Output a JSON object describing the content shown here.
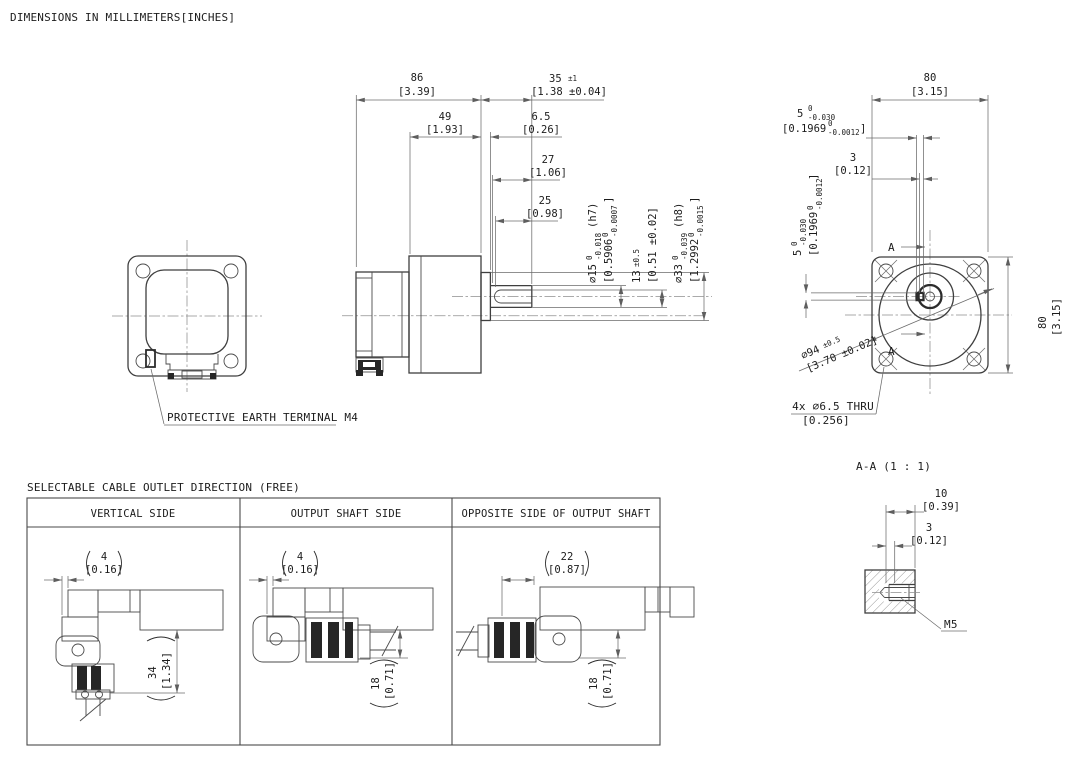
{
  "note": "DIMENSIONS IN MILLIMETERS[INCHES]",
  "colors": {
    "object_line": "#3f3f3f",
    "dim_line": "#6b6b6b",
    "text": "#1c1c1c",
    "background": "#ffffff"
  },
  "side_view": {
    "d86": {
      "mm": "86",
      "inch": "[3.39]"
    },
    "d35": {
      "mm": "35",
      "tol": "±1",
      "inch": "[1.38 ±0.04]"
    },
    "d49": {
      "mm": "49",
      "inch": "[1.93]"
    },
    "d6_5": {
      "mm": "6.5",
      "inch": "[0.26]"
    },
    "d27": {
      "mm": "27",
      "inch": "[1.06]"
    },
    "d25": {
      "mm": "25",
      "inch": "[0.98]"
    },
    "shaft_dia": {
      "mm": "∅15",
      "tol_top": "0",
      "tol_bot": "-0.018",
      "fit": "(h7)",
      "inch": "[0.5906",
      "inch_tol_top": "0",
      "inch_tol_bot": "-0.0007",
      "inch_close": "]"
    },
    "key_height": {
      "mm": "13",
      "tol": "±0.5",
      "inch": "[0.51 ±0.02]"
    },
    "boss_dia": {
      "mm": "∅33",
      "tol_top": "0",
      "tol_bot": "-0.039",
      "fit": "(h8)",
      "inch": "[1.2992",
      "inch_tol_top": "0",
      "inch_tol_bot": "-0.0015",
      "inch_close": "]"
    },
    "earth_label": "PROTECTIVE EARTH TERMINAL M4"
  },
  "front_view": {
    "d80_top": {
      "mm": "80",
      "inch": "[3.15]"
    },
    "d80_right": {
      "mm": "80",
      "inch": "[3.15]"
    },
    "key_width": {
      "mm": "5",
      "tol_top": "0",
      "tol_bot": "-0.030",
      "inch": "[0.1969",
      "inch_tol_top": "0",
      "inch_tol_bot": "-0.0012",
      "inch_close": "]"
    },
    "key_offset": {
      "mm": "3",
      "inch": "[0.12]"
    },
    "key_height": {
      "mm": "5",
      "tol_top": "0",
      "tol_bot": "-0.030",
      "inch": "[0.1969",
      "inch_tol_top": "0",
      "inch_tol_bot": "-0.0012",
      "inch_close": "]"
    },
    "bolt_circle": {
      "mm": "∅94",
      "tol": "±0.5",
      "inch": "[3.70 ±0.02]"
    },
    "mounting_holes": {
      "line1": "4x ∅6.5 THRU",
      "line2": "[0.256]"
    },
    "section_label": "A"
  },
  "section_view": {
    "title": "A-A (1 : 1)",
    "d10": {
      "mm": "10",
      "inch": "[0.39]"
    },
    "d3": {
      "mm": "3",
      "inch": "[0.12]"
    },
    "thread": "M5"
  },
  "cable_table": {
    "title": "SELECTABLE CABLE OUTLET DIRECTION (FREE)",
    "columns": [
      {
        "header": "VERTICAL SIDE",
        "dim_top": {
          "mm": "4",
          "inch": "[0.16]"
        },
        "dim_side": {
          "mm": "34",
          "inch": "[1.34]"
        }
      },
      {
        "header": "OUTPUT SHAFT SIDE",
        "dim_top": {
          "mm": "4",
          "inch": "[0.16]"
        },
        "dim_side": {
          "mm": "18",
          "inch": "[0.71]"
        }
      },
      {
        "header": "OPPOSITE SIDE OF OUTPUT SHAFT",
        "dim_top": {
          "mm": "22",
          "inch": "[0.87]"
        },
        "dim_side": {
          "mm": "18",
          "inch": "[0.71]"
        }
      }
    ]
  }
}
